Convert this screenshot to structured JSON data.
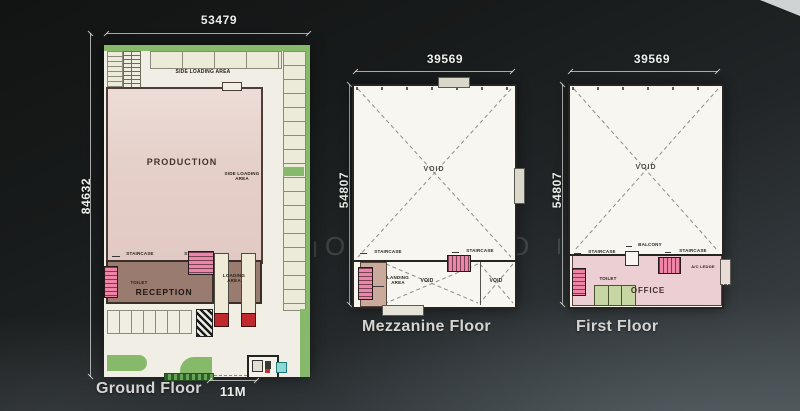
{
  "watermark": {
    "l1": "I",
    "l2": "O",
    "l3": "E",
    "l4": "O",
    "l5": "O",
    "l6": "I"
  },
  "colors": {
    "background_dark": "#1a1d1d",
    "paper_white": "#f2efe7",
    "landscape_green": "#87b96b",
    "production_pink": "#e6cfca",
    "reception_brown": "#9a7b6f",
    "staircase_pink": "#ef85a6",
    "truck_red": "#c02a2e",
    "office_pink": "#eccfd2",
    "toilet_green": "#c7d7a3",
    "landing_tan": "#c9aa9c",
    "guardhouse_cyan": "#8fd8d6",
    "dimension_text": "#edefec"
  },
  "ground_floor": {
    "title": "Ground Floor",
    "dim_width": "53479",
    "dim_height": "84632",
    "gate_dim": "11M",
    "labels": {
      "side_loading_top": "SIDE LOADING AREA",
      "production": "PRODUCTION",
      "side_loading_right": "SIDE LOADING AREA",
      "staircase_left": "STAIRCASE",
      "staircase_right": "STAIRCASE",
      "toilet": "TOILET",
      "reception": "RECEPTION",
      "loading_area": "LOADING AREA"
    }
  },
  "mezzanine_floor": {
    "title": "Mezzanine Floor",
    "dim_width": "39569",
    "dim_height": "54807",
    "labels": {
      "void_main": "VOID",
      "staircase_left": "STAIRCASE",
      "staircase_right": "STAIRCASE",
      "landing_area": "LANDING AREA",
      "void_center": "VOID",
      "void_right": "VOID"
    }
  },
  "first_floor": {
    "title": "First Floor",
    "dim_width": "39569",
    "dim_height": "54807",
    "labels": {
      "void_main": "VOID",
      "staircase_left": "STAIRCASE",
      "balcony": "BALCONY",
      "staircase_right": "STAIRCASE",
      "ac_ledge": "A/C LEDGE",
      "toilet": "TOILET",
      "office": "OFFICE"
    }
  }
}
